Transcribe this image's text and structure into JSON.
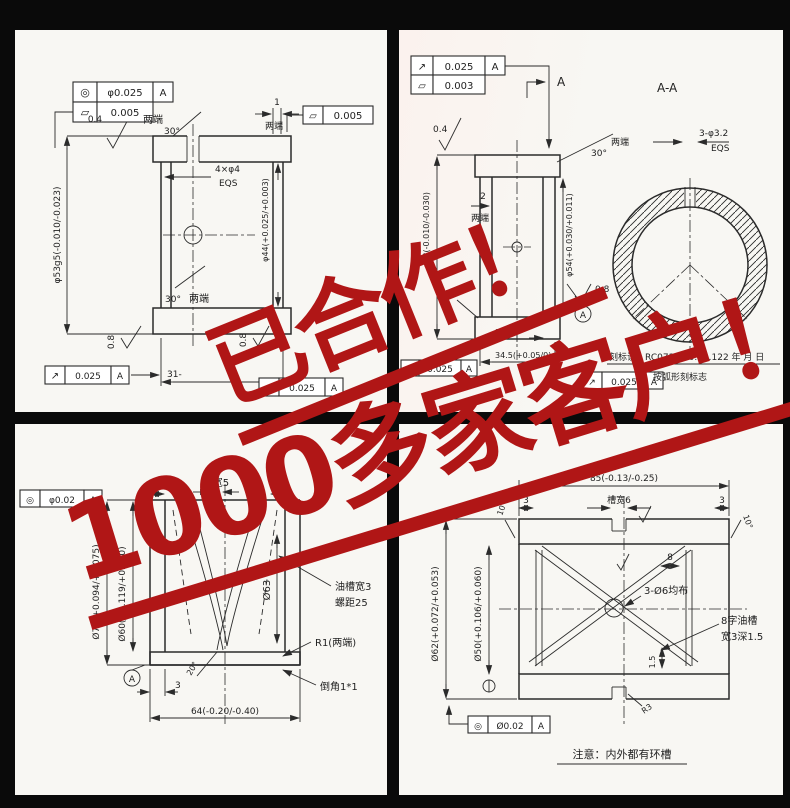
{
  "watermark": {
    "line1": "已合作！",
    "line2": "1000多家客户！",
    "color": "#b01616"
  },
  "panels": {
    "tl": {
      "sym_position": "◎",
      "tol_position": "φ0.025",
      "datum_a": "A",
      "sym_parallel": "▱",
      "tol_parallel": "0.005",
      "finish_top": "0.4",
      "both_ends_top": "两端",
      "chamfer_top": "30°",
      "dim_groove": "1",
      "both_ends_groove": "两端",
      "sym_parallel2": "▱",
      "tol_parallel2": "0.005",
      "holes": "4×φ4",
      "eqs": "EQS",
      "dia_outer": "φ53g5(-0.010/-0.023)",
      "dia_bore": "φ44(+0.025/+0.003)",
      "finish_left": "0.8",
      "finish_right": "0.8",
      "chamfer_bottom": "30°",
      "both_ends_bottom": "两端",
      "sym_runout": "↗",
      "tol_runout": "0.025",
      "datum_runout": "A",
      "sym_runout2": "↗",
      "tol_runout2": "0.025",
      "datum_runout2": "A",
      "dim_length": "31-"
    },
    "tr": {
      "sym_runout": "↗",
      "tol_runout": "0.025",
      "datum_a": "A",
      "sym_parallel": "▱",
      "tol_parallel": "0.003",
      "section_arrow_label": "A",
      "finish_top": "0.4",
      "dim_groove": "2",
      "both_ends_groove": "两端",
      "chamfer": "30°",
      "both_ends": "两端",
      "dia_outer": "φ68(-0.010/-0.030)",
      "dia_bore": "φ54(+0.030/+0.011)",
      "section_title": "A-A",
      "holes": "3-φ3.2",
      "eqs": "EQS",
      "radius": "R0.5",
      "finish_side": "0.8",
      "datum_balloon": "A",
      "mark_line1": "刻标识B RC073.800.41.122 年 月 日",
      "mark_line2": "按弧形刻标志",
      "sym_runout2": "↗",
      "tol_runout2": "0.025",
      "datum2": "A",
      "sym_runout3": "↗",
      "tol_runout3": "0.025",
      "datum3": "A",
      "dim_a": "17.26",
      "dim_b": "34.5(+0.05/0)"
    },
    "bl": {
      "sym_position": "◎",
      "tol_position": "φ0.02",
      "datum_a": "A",
      "groove_width": "槽宽5",
      "dim_left": "7",
      "dim_right": "7",
      "dia_outer": "Ø72(+0.094/+0.075)",
      "dia_mid": "Ø60(+0.119/+0.100)",
      "dia_groove": "Ø63",
      "oil_line1": "油槽宽3",
      "oil_line2": "螺距25",
      "radius": "R1(两端)",
      "chamfer": "倒角1*1",
      "datum_balloon": "A",
      "dim_edge": "3",
      "dim_length": "64(-0.20/-0.40)",
      "angle": "20°"
    },
    "br": {
      "dim_length": "85(-0.13/-0.25)",
      "dim_edge_l": "3",
      "groove_width": "槽宽6",
      "dim_edge_r": "3",
      "angle_l": "10°",
      "angle_r": "10°",
      "dia_outer": "Ø62(+0.072/+0.053)",
      "dia_bore": "Ø50(+0.106/+0.060)",
      "holes": "3-Ø6均布",
      "oil_line1": "8字油槽",
      "oil_line2": "宽3深1.5",
      "dim_depth": "1.5",
      "dim_spacing": "8",
      "radius": "R3",
      "sym_position": "◎",
      "tol_position": "Ø0.02",
      "datum_a": "A",
      "note": "注意：内外都有环槽"
    }
  }
}
